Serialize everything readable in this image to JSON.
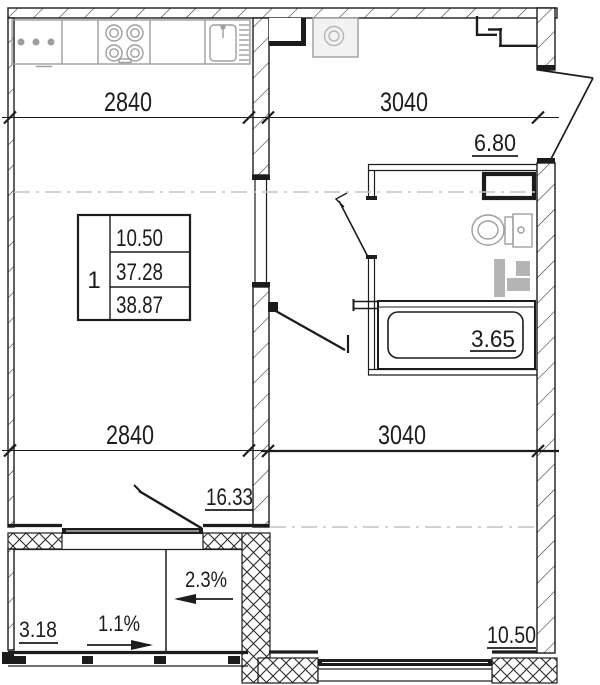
{
  "plan": {
    "type": "apartment-floor-plan",
    "colors": {
      "wall": "#1c1c1c",
      "fixture": "#9e9e9e",
      "guide": "#c4c4c4"
    },
    "dimensions": {
      "top_left": "2840",
      "top_right": "3040",
      "mid_left": "2840",
      "mid_right": "3040"
    },
    "areas": {
      "hallway": "6.80",
      "bathroom": "3.65",
      "kitchen_living": "16.33",
      "bedroom": "10.50",
      "balcony": "3.18"
    },
    "slopes": {
      "balcony_floor": "1.1%",
      "loggia_floor": "2.3%"
    },
    "info_table": {
      "rooms": "1",
      "rows": [
        "10.50",
        "37.28",
        "38.87"
      ]
    }
  }
}
